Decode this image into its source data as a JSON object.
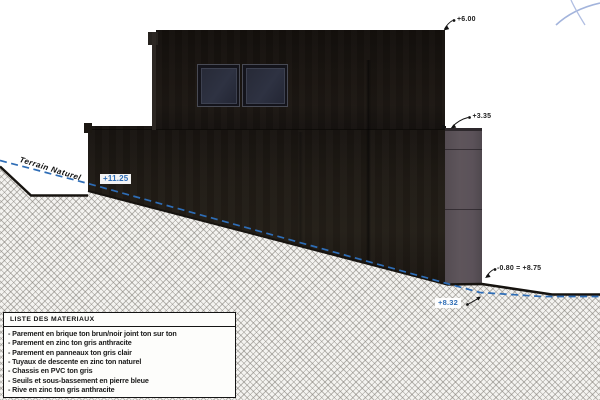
{
  "colors": {
    "accent_blue": "#2e6db6",
    "line_black": "#16130f",
    "facade_dark": "#1d1813",
    "panel_gray": "#5b5259"
  },
  "drawing": {
    "terrain_label": "Terrain Naturel",
    "annotations": {
      "roof": "+6.00",
      "mid": "+3.35",
      "platform": "+11.25",
      "base_rel": "-0.80 = ",
      "base_abs": "+8.75",
      "ground": "+8.32"
    }
  },
  "materials": {
    "title": "LISTE DES MATERIAUX",
    "items": [
      "- Parement en brique ton brun/noir joint ton sur ton",
      "- Parement en zinc ton gris anthracite",
      "- Parement en panneaux ton gris clair",
      "- Tuyaux de descente en zinc ton naturel",
      "- Chassis en PVC ton gris",
      "- Seuils et sous-bassement en pierre bleue",
      "- Rive en zinc ton gris anthracite"
    ]
  }
}
